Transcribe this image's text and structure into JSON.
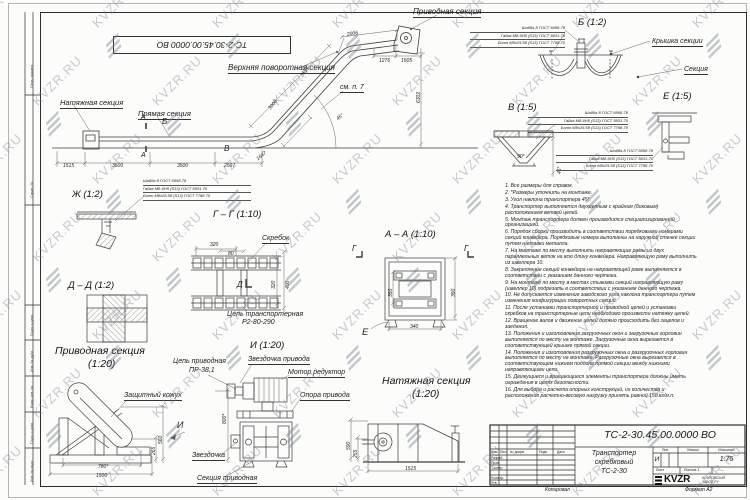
{
  "sheet": {
    "stamp_top_left": "ТС-2-30.45.00.0000 ВО",
    "watermark_text": "KVZR.RU",
    "copied_by": "Копировал",
    "format_label": "Формат А2"
  },
  "margin_labels": {
    "perv_primen": "Перв. примен.",
    "sprav": "Справ. №",
    "podp_data_1": "Подп. и дата",
    "inv_dubl": "Инв. № дубл.",
    "vzam_inv": "Взам. инв. №",
    "podp_data_2": "Подп. и дата",
    "inv_podl": "Инв. № подл."
  },
  "fastener_note": [
    "Шайба 8 ГОСТ 6958-78",
    "Гайка М8-6Н5 (S13) ГОСТ 5931-70",
    "Болт М8х25.58 (S13) ГОСТ 7798-70"
  ],
  "main_view": {
    "labels": {
      "top_turn": "Верхняя поворотная секция",
      "drive": "Приводная секция",
      "tension": "Натяжная секция",
      "straight": "Прямая секция",
      "see_note": "см. п. 7"
    },
    "marks": {
      "a": "А",
      "b": "Б",
      "v": "В"
    },
    "dims": {
      "d2006": "2006",
      "d1276": "1276",
      "d1505": "1505",
      "d3539": "3539",
      "d3000": "3000",
      "d6302": "6302",
      "d1647": "1647",
      "d1515": "1515",
      "d3500a": "3500",
      "d3500b": "3500",
      "d2507": "2507",
      "angle": "45°"
    }
  },
  "detail_b": {
    "title": "Б (1:2)",
    "cover": "Крышка секции",
    "section": "Секция"
  },
  "detail_v": {
    "title": "В (1:5)",
    "angle90": "90°",
    "angle45": "45°"
  },
  "detail_e": {
    "title": "Е (1:5)"
  },
  "detail_zh": {
    "title": "Ж (1:2)"
  },
  "section_dd": {
    "title": "Д – Д (1:2)"
  },
  "section_gg": {
    "title": "Г – Г (1:10)",
    "scraper": "Скребок",
    "chain_line1": "Цепь транспортерная",
    "chain_line2": "Р2-80-290",
    "mark": "Д",
    "dims": {
      "d320_top": "320",
      "d80": "80",
      "d320_side": "320",
      "d400": "400"
    }
  },
  "section_aa": {
    "title": "А – А (1:10)",
    "mark_g": "Г",
    "mark_e": "Е",
    "dims": {
      "d350": "350",
      "d390": "390",
      "d340": "340"
    }
  },
  "drive_view": {
    "title_line1": "Приводная секция",
    "title_line2": "(1:20)",
    "chain_line1": "Цепь приводная",
    "chain_line2": "ПР-38,1",
    "guard": "Защитный кожух",
    "mark_i": "И",
    "dims": {
      "d780": "780*",
      "d1500": "1500",
      "d560": "560",
      "d265": "265",
      "d800": "800*"
    }
  },
  "i_view": {
    "title": "И (1:20)",
    "sprocket_drive": "Звездочка привода",
    "motor": "Мотор редуктор",
    "support": "Опора привода",
    "sprocket": "Звездочка",
    "drive_section": "Секция приводная"
  },
  "tension_view": {
    "title_line1": "Натяжная секция",
    "title_line2": "(1:20)",
    "dims": {
      "d1515": "1515",
      "d590": "590",
      "d255": "255"
    }
  },
  "notes": [
    "1. Все размеры для справок.",
    "2. *Размеры уточнить на монтаже.",
    "3. Угол наклона транспортера 45°.",
    "4. Транспортер выполняется двухцепным с крайним (боковым) расположением ветвей цепей.",
    "5. Монтаж транспортера должен производится специализированной организацией.",
    "6. Порядок сборки производить в соответствии порядковыми номерами секций конвейера. Порядковые номера выполнены на наружной стенке секции путем наплавки металла.",
    "7. На монтаже по месту выполнить направляющие рамы из двух параллельных веток на всю длину конвейера. Направляющую раму выполнить из швеллера 10.",
    "8. Закрепление секций конвейера на направляющей раме выполняется в соответствии с указанием данного чертежа.",
    "9. На монтаже по месту в местах стыковки секций направляющую раму (швеллер 10) подрезать в соответствии с указанием данного чертежа.",
    "10. Не допускается изменение заводского угла наклона транспортера путем изменения конфигурации поворотных секций.",
    "11. После установки транспортерной и приводной цепей и установки скребков на транспортерные цепи необходимо произвести натяжку цепей.",
    "12. Вращение валов и движение цепей должно происходить без зацепов и заедания.",
    "13. Положения и изготовления загрузочных окон и загрузочных горловин выполняется по месту на монтаже. Загрузочные окна вырезается в соответствующей крышке прямой секции.",
    "14. Положения и изготовления разгрузочных окна и разгрузочных горловин выполняется по месту на монтаже. Разгрузочные окна вырезается в соответствующем нижнем поддоне прямой секции между нижними направляющими цепи.",
    "15. Движущиеся и вращающиеся элементы транспортера должны иметь ограждения в целях безопасности.",
    "16. Для выбора и расчета опорных конструкций, их количества и расположения расчетно-весовую нагрузку принять равной 150 кг/м.п."
  ],
  "title_block": {
    "doc_number": "ТС-2-30.45.00.0000 ВО",
    "name_line1": "Транспортер",
    "name_line2": "скребковый",
    "name_line3": "ТС-2-30",
    "lit_header": "Лит.",
    "mass_header": "Масса",
    "scale_header": "Масштаб",
    "lit_value": "И",
    "scale_value": "1:75",
    "sheet_label": "Лист",
    "sheets_label": "Листов 1",
    "logo_text": "KVZR",
    "logo_sub": "КОВРОВСКИЙ ЗАВОД.РУ",
    "col_izm": "Изм.",
    "col_list": "Лист",
    "col_doc": "№ докум.",
    "col_podp": "Подп.",
    "col_data": "Дата",
    "row_razrab": "Разраб.",
    "row_prov": "Пров.",
    "row_tkontr": "Т.контр.",
    "row_nkontr": "Н.контр.",
    "row_utv": "Утв."
  }
}
